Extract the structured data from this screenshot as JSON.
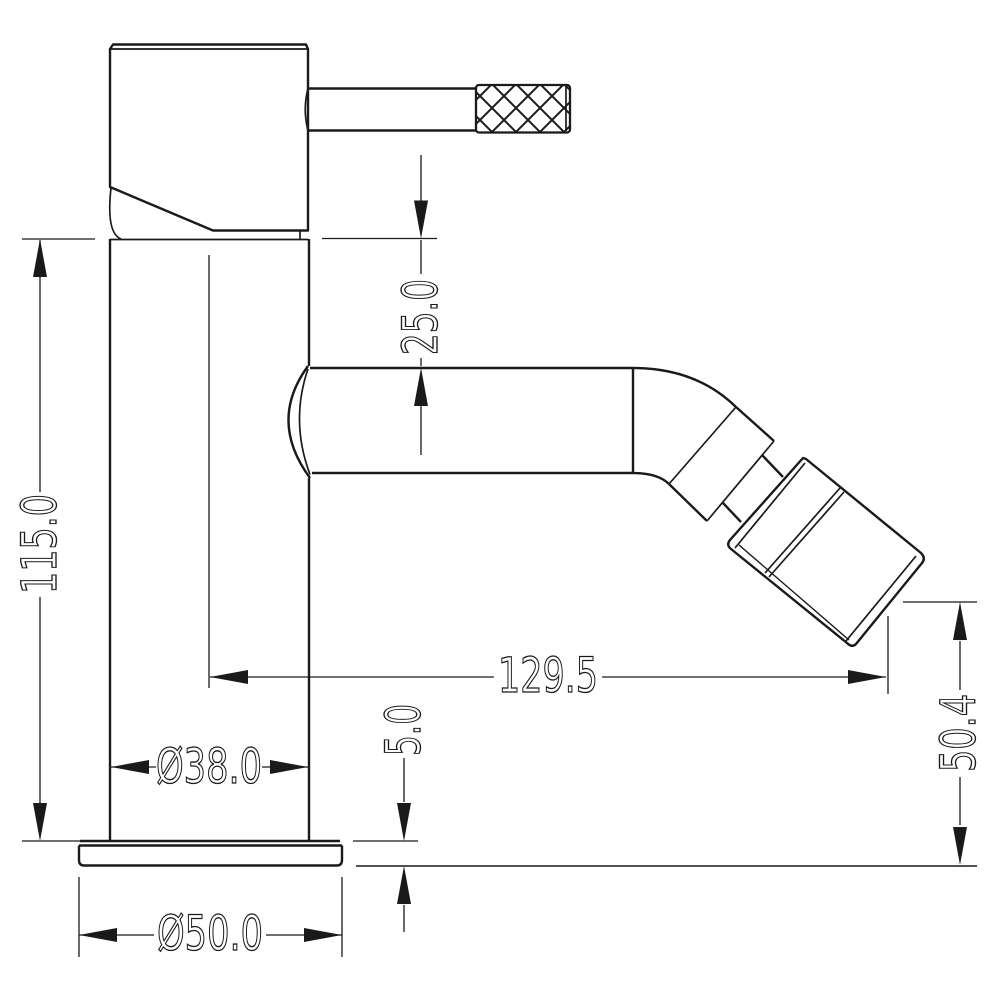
{
  "drawing": {
    "background_color": "#ffffff",
    "line_color": "#1a1a1a",
    "dimensions": {
      "overall_height": "115.0",
      "body_to_spout_drop": "25.0",
      "spout_reach": "129.5",
      "outlet_height": "50.4",
      "body_diameter": "Ø38.0",
      "base_diameter": "Ø50.0",
      "base_plate_thickness": "5.0"
    }
  }
}
